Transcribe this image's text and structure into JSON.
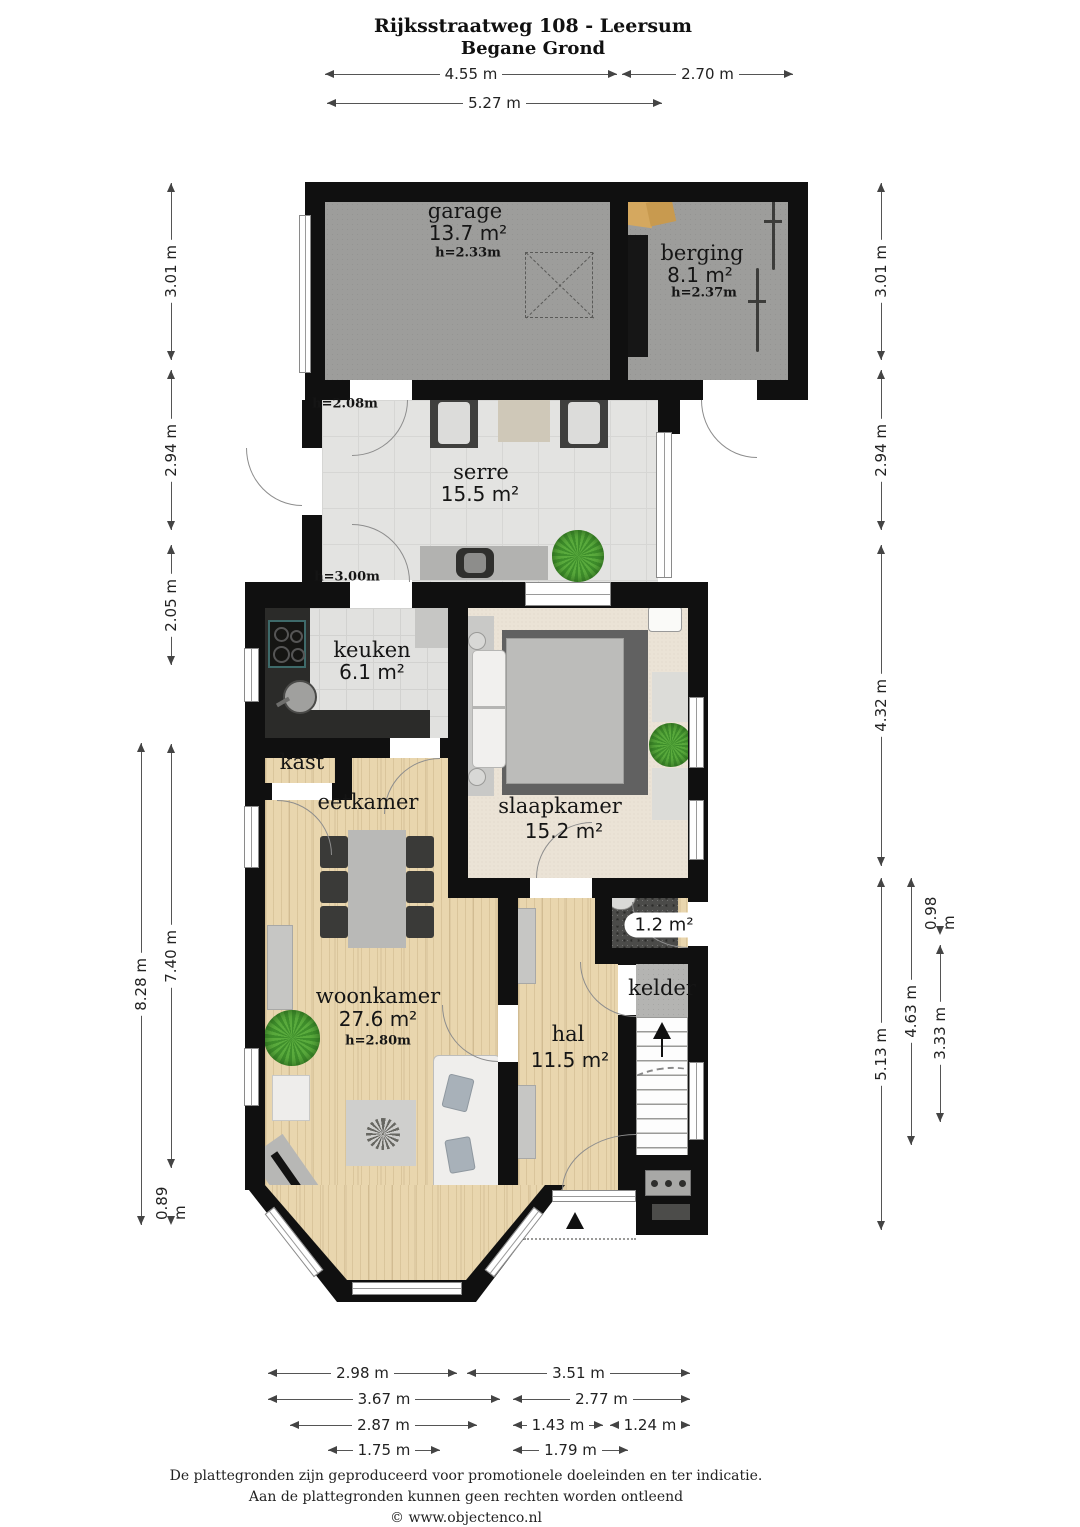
{
  "title": {
    "line1": "Rijksstraatweg 108 - Leersum",
    "line2": "Begane Grond"
  },
  "rooms": {
    "garage": {
      "name": "garage",
      "area": "13.7 m²",
      "ceiling": "h=2.33m"
    },
    "berging": {
      "name": "berging",
      "area": "8.1 m²",
      "ceiling": "h=2.37m"
    },
    "serre": {
      "name": "serre",
      "area": "15.5 m²",
      "note_top": "h=2.08m",
      "note_bottom": "h=3.00m"
    },
    "keuken": {
      "name": "keuken",
      "area": "6.1 m²"
    },
    "kast": {
      "name": "kast"
    },
    "slaapkamer": {
      "name": "slaapkamer",
      "area": "15.2 m²"
    },
    "eetkamer": {
      "name": "eetkamer"
    },
    "woonkamer": {
      "name": "woonkamer",
      "area": "27.6 m²",
      "ceiling": "h=2.80m"
    },
    "toilet": {
      "area": "1.2 m²"
    },
    "kelder": {
      "name": "kelder"
    },
    "hal": {
      "name": "hal",
      "area": "11.5 m²"
    }
  },
  "dimensions": {
    "top": [
      "4.55 m",
      "2.70 m",
      "5.27 m"
    ],
    "left": [
      "3.01 m",
      "2.94 m",
      "2.05 m",
      "7.40 m",
      "8.28 m",
      "0.89 m"
    ],
    "right": [
      "3.01 m",
      "2.94 m",
      "4.32 m",
      "5.13 m",
      "4.63 m",
      "0.98 m",
      "3.33 m"
    ],
    "bottom": [
      "2.98 m",
      "3.51 m",
      "3.67 m",
      "2.77 m",
      "2.87 m",
      "1.43 m",
      "1.24 m",
      "1.75 m",
      "1.79 m"
    ]
  },
  "footer": {
    "line1": "De plattegronden zijn geproduceerd voor promotionele doeleinden en ter indicatie.",
    "line2": "Aan de plattegronden kunnen geen rechten worden ontleend",
    "line3": "© www.objectenco.nl"
  },
  "colors": {
    "wall": "#101010",
    "wood_floor": "#e9d6ae",
    "carpet": "#ebe3d6",
    "tile": "#e3e3e1",
    "concrete": "#9d9d9b",
    "plant": "#4f9b38",
    "rug_dark": "#616161"
  }
}
